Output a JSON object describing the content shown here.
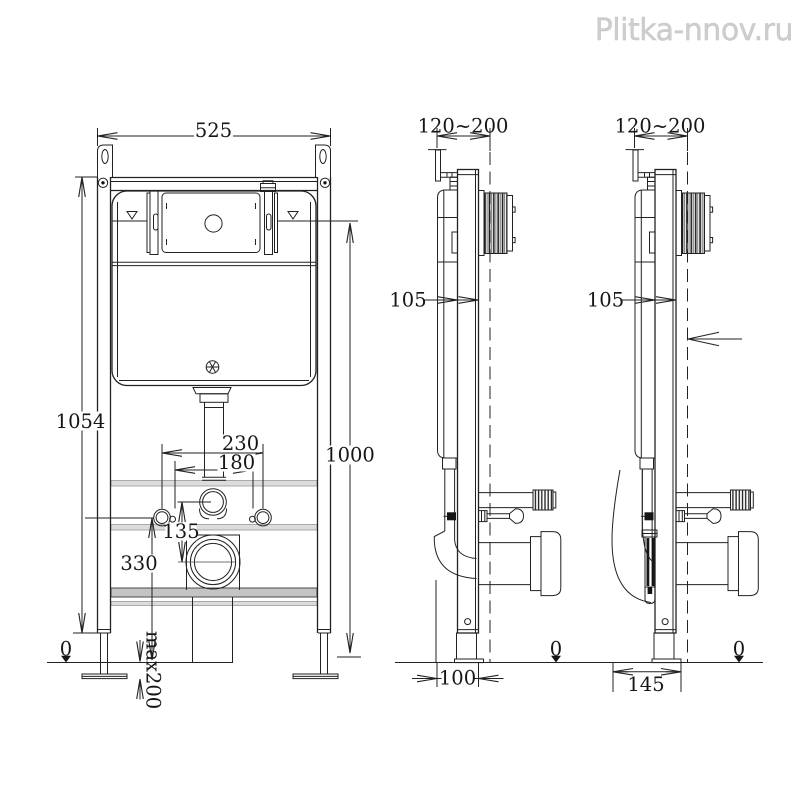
{
  "watermark": "Plitka-nnov.ru",
  "colors": {
    "line": "#222222",
    "watermark": "#cecece",
    "rail_light": "#dcdcdc",
    "rail_dark": "#c4c4c4"
  },
  "front": {
    "width": "525",
    "frame_height": "1054",
    "button_center_height": "1000",
    "fixing_spacing_outer": "230",
    "fixing_spacing_inner": "180",
    "inlet_to_outlet": "135",
    "outlet_height": "330",
    "floor_level": "0",
    "leg_extension": "max200"
  },
  "side1": {
    "wall_offset_range": "120~200",
    "frame_depth": "105",
    "outlet_offset": "100",
    "floor_level": "0"
  },
  "side2": {
    "wall_offset_range": "120~200",
    "frame_depth": "105",
    "outlet_offset": "145",
    "floor_level": "0"
  }
}
